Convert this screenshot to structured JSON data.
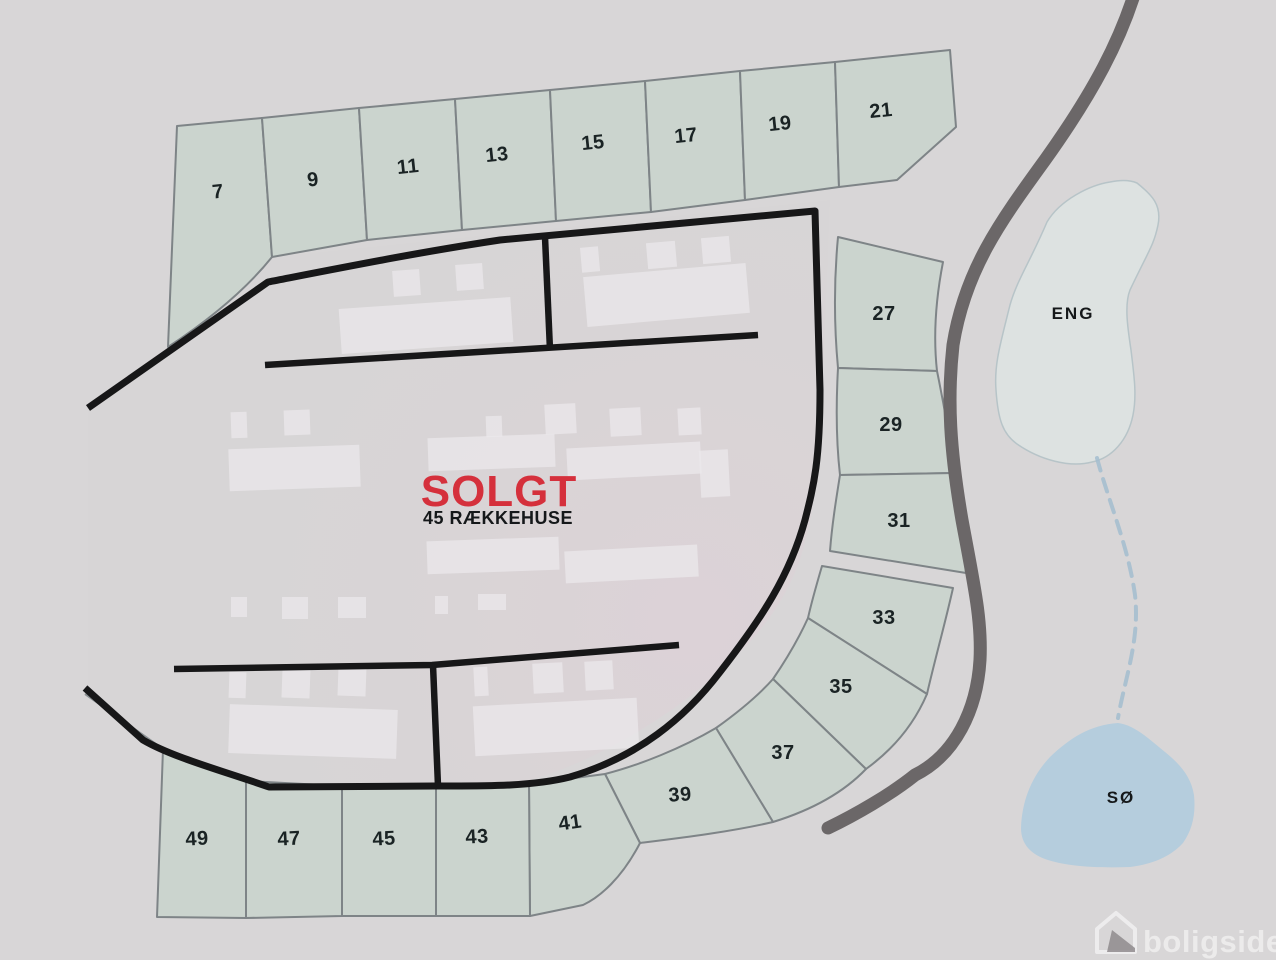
{
  "plots": [
    {
      "label": "7"
    },
    {
      "label": "9"
    },
    {
      "label": "11"
    },
    {
      "label": "13"
    },
    {
      "label": "15"
    },
    {
      "label": "17"
    },
    {
      "label": "19"
    },
    {
      "label": "21"
    },
    {
      "label": "27"
    },
    {
      "label": "29"
    },
    {
      "label": "31"
    },
    {
      "label": "33"
    },
    {
      "label": "35"
    },
    {
      "label": "37"
    },
    {
      "label": "39"
    },
    {
      "label": "41"
    },
    {
      "label": "43"
    },
    {
      "label": "45"
    },
    {
      "label": "47"
    },
    {
      "label": "49"
    }
  ],
  "center": {
    "sold_label": "SOLGT",
    "units_label": "45 RÆKKEHUSE"
  },
  "areas": {
    "meadow_label": "ENG",
    "lake_label": "SØ"
  },
  "watermark": {
    "brand": "boligsiden"
  },
  "colors": {
    "background": "#d8d6d7",
    "plot_fill": "#cbd4ce",
    "plot_stroke": "#7e8487",
    "road_black": "#171718",
    "road_gray": "#6b6768",
    "sold_red": "#d5303c",
    "label_dark": "#1a2324",
    "lake_fill": "#b5cddd",
    "meadow_fill": "#dde2e1",
    "meadow_stroke": "#b7c4c8",
    "stream_blue": "#a3bdcf",
    "building_white": "#ece9eb",
    "inner_pink": "#dcd2d7"
  }
}
